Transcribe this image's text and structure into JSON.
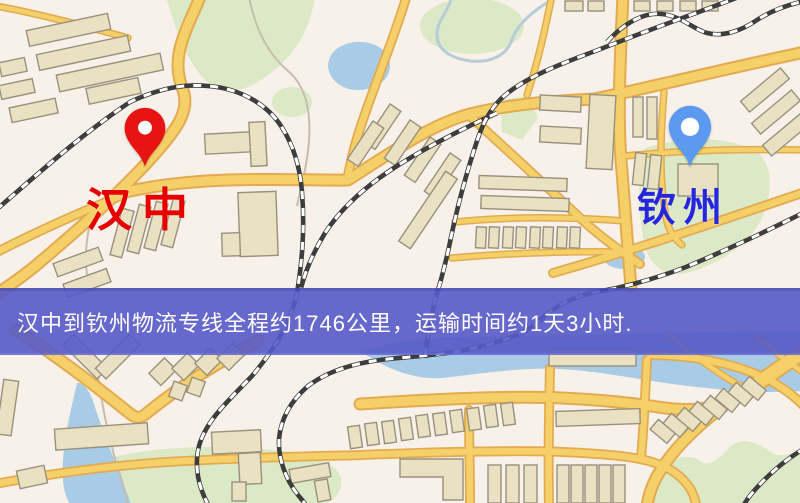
{
  "map": {
    "type": "road-map",
    "origin": {
      "name": "汉中",
      "marker": "map-pin",
      "pin_color": "#e81414",
      "label_color": "#e60000"
    },
    "destination": {
      "name": "钦州",
      "marker": "map-pin",
      "pin_color": "#5b9af0",
      "label_color": "#2626dd"
    }
  },
  "banner": {
    "text": "汉中到钦州物流专线全程约1746公里，运输时间约1天3小时.",
    "route": {
      "origin": "汉中",
      "destination": "钦州",
      "service": "物流专线",
      "distance_km": 1746,
      "duration": "1天3小时"
    },
    "bg_color": "#575bc8",
    "text_color": "#ffffff"
  },
  "colors": {
    "map_bg": "#f8f1e9",
    "road_fill": "#f5d069",
    "road_casing": "#e2ab52",
    "building_fill": "#eae0c2",
    "building_stroke": "#98917e",
    "park": "#dce9c6",
    "water": "#a8cbe6",
    "railway": "#3d3d3d",
    "contour": "#c5beb0"
  }
}
